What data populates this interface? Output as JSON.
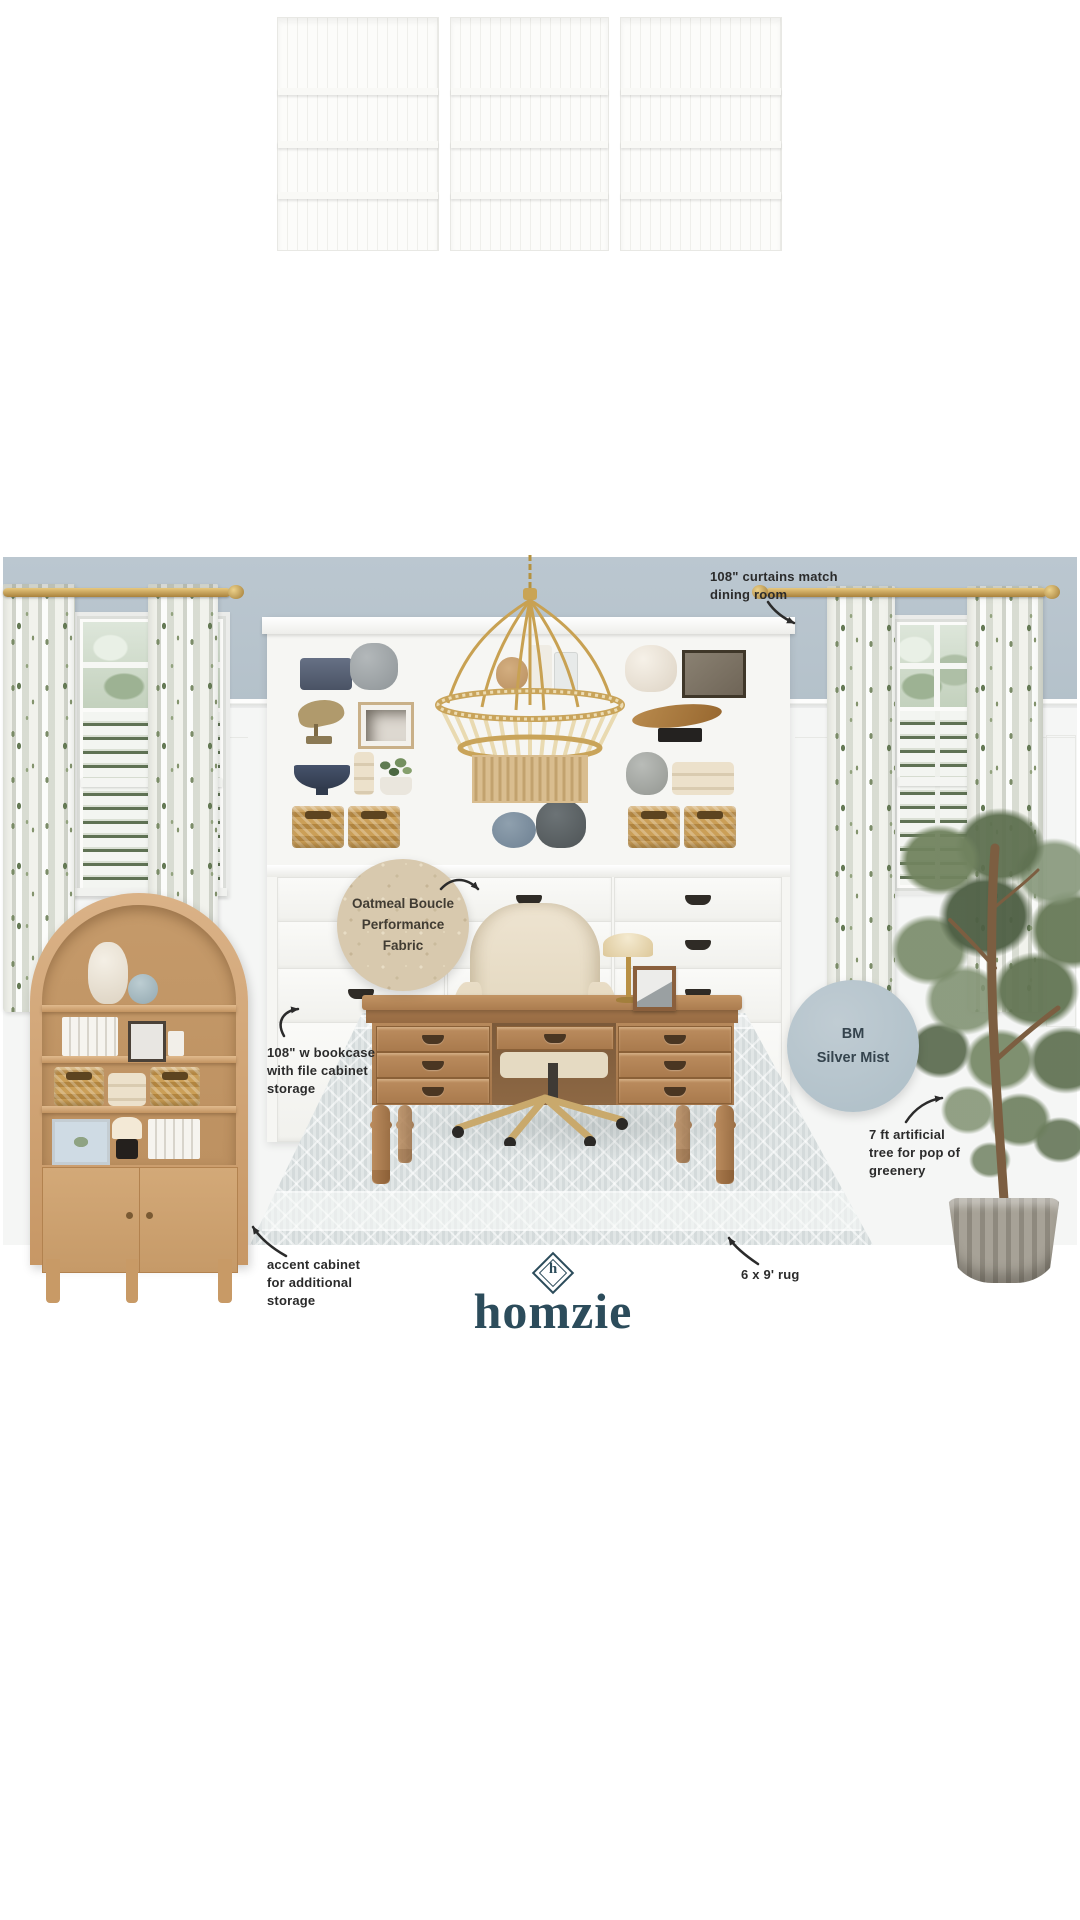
{
  "annotations": {
    "curtains": {
      "l1": "108\" curtains match",
      "l2": "dining room"
    },
    "bookcase": {
      "l1": "108\" w bookcase",
      "l2": "with file cabinet",
      "l3": "storage"
    },
    "accent": {
      "l1": "accent cabinet",
      "l2": "for additional",
      "l3": "storage"
    },
    "rug": {
      "l1": "6 x 9' rug"
    },
    "tree": {
      "l1": "7 ft artificial",
      "l2": "tree for pop of",
      "l3": "greenery"
    }
  },
  "swatches": {
    "fabric": {
      "l1": "Oatmeal Boucle",
      "l2": "Performance",
      "l3": "Fabric",
      "color": "#d8c9ae"
    },
    "paint": {
      "l1": "BM",
      "l2": "Silver Mist",
      "color": "#b5c4cc"
    }
  },
  "logo": {
    "wordmark": "homzie",
    "monogram": "h",
    "color": "#2c4c5b"
  },
  "palette": {
    "wall": "#b8c4cd",
    "wainscot": "#f5f6f5",
    "rod_gold": "#c09a4e",
    "oak": "#d0a674",
    "desk_wood": "#ad7f52",
    "hutch_white": "#f7f7f4",
    "rug": "#e1e6e6",
    "olive_green": "#6e805c",
    "chair_boucle": "#e9dfca",
    "annotation_ink": "#2b2b2b"
  }
}
